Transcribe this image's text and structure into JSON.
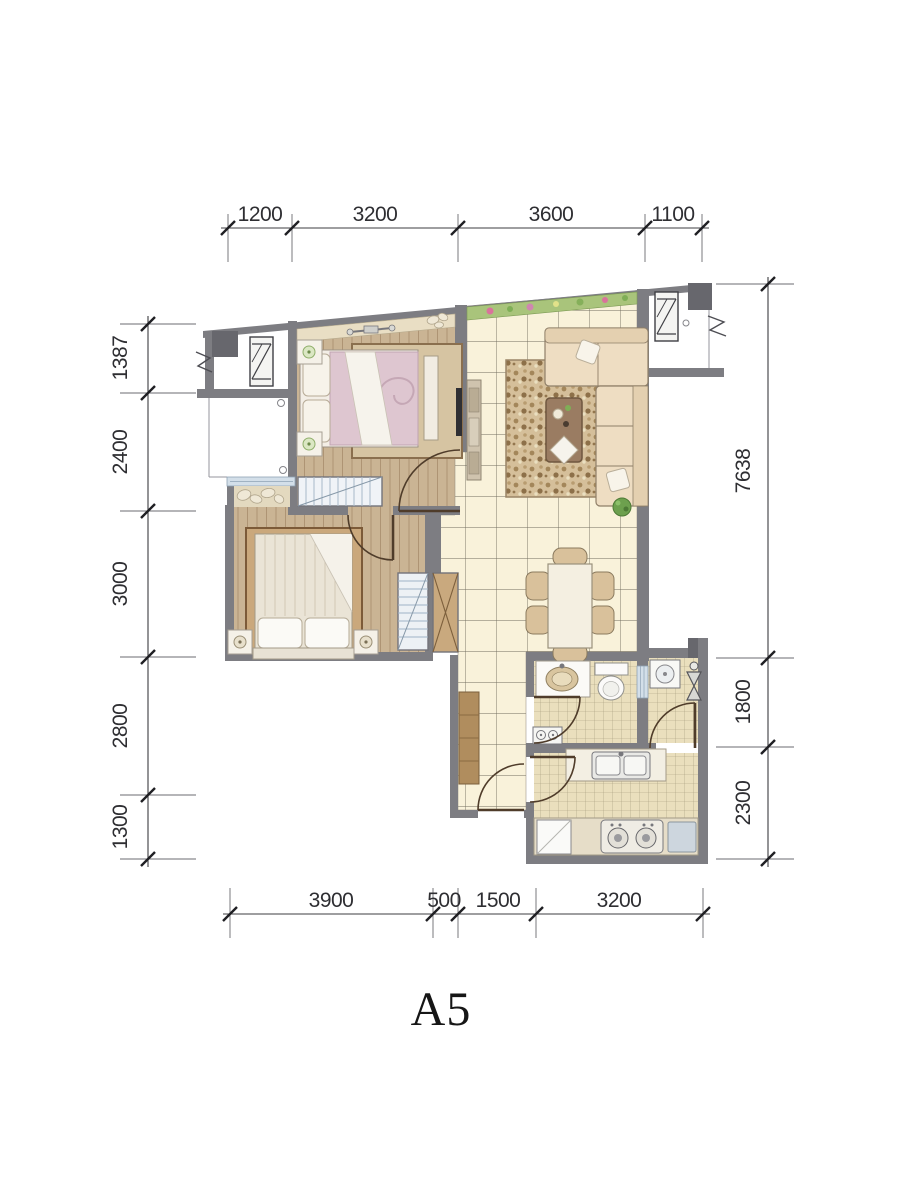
{
  "plan": {
    "label": "A5"
  },
  "dimensions": {
    "top": [
      "1200",
      "3200",
      "3600",
      "1100"
    ],
    "bottom": [
      "3900",
      "500",
      "1500",
      "3200"
    ],
    "left": [
      "1387",
      "2400",
      "3000",
      "2800",
      "1300"
    ],
    "right": [
      "7638",
      "1800",
      "2300"
    ]
  },
  "colors": {
    "wall": "#7d7d82",
    "column": "#67676d",
    "wood_floor": "#cab494",
    "hall_tile": "#f9f2da",
    "wet_tile": "#eadfbd",
    "planter_green": "#a9c47b",
    "window_glass": "#d3dfe9",
    "dimension_text": "#2e2e32"
  },
  "icons": {
    "ac_unit": "rectangle with Z-diagonal (outdoor AC unit)",
    "break_line": "zigzag continuation mark",
    "door": "quarter-circle swing arc",
    "wardrobe": "striped hanging-clothes box",
    "closet_x": "crossed-diagonals cabinet",
    "stove": "two-burner cooktop",
    "sink": "oval basin",
    "toilet": "tank and bowl",
    "washer": "square with drum circle"
  }
}
